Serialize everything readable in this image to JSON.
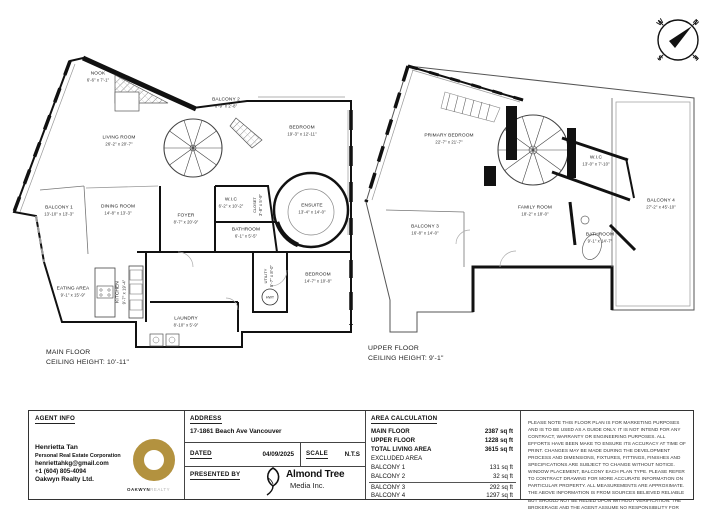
{
  "compass": {
    "n": "N",
    "e": "E",
    "s": "S",
    "w": "W"
  },
  "main_floor": {
    "title": "MAIN FLOOR",
    "ceiling": "CEILING HEIGHT: 10'-11\"",
    "hwt": "HWT",
    "rooms": [
      {
        "name": "NOOK",
        "dims": "6'-6\" x 7'-1\""
      },
      {
        "name": "LIVING ROOM",
        "dims": "26'-2\" x 20'-7\""
      },
      {
        "name": "BALCONY 2",
        "dims": "8'-9\" x 2'-8\""
      },
      {
        "name": "BEDROOM",
        "dims": "19'-3\" x 12'-11\""
      },
      {
        "name": "BALCONY 1",
        "dims": "13'-10\" x 13'-3\""
      },
      {
        "name": "DINING ROOM",
        "dims": "14'-8\" x 13'-3\""
      },
      {
        "name": "FOYER",
        "dims": "8'-7\" x 20'-9\""
      },
      {
        "name": "W.I.C",
        "dims": "6'-2\" x 10'-2\""
      },
      {
        "name": "ENSUITE",
        "dims": "13'-4\" x 14'-0\""
      },
      {
        "name": "BATHROOM",
        "dims": "6'-1\" x 5'-5\""
      },
      {
        "name": "CLOSET",
        "dims": "3'-8\" x 5'-9\""
      },
      {
        "name": "EATING AREA",
        "dims": "9'-1\" x 15'-9\""
      },
      {
        "name": "KITCHEN",
        "dims": "9'-7\" x 19'-4\""
      },
      {
        "name": "BEDROOM",
        "dims": "14'-7\" x 10'-8\""
      },
      {
        "name": "UTILITY",
        "dims": "5'-7\" x 8'-0\""
      },
      {
        "name": "LAUNDRY",
        "dims": "8'-10\" x 5'-9\""
      }
    ]
  },
  "upper_floor": {
    "title": "UPPER FLOOR",
    "ceiling": "CEILING HEIGHT: 9'-1\"",
    "rooms": [
      {
        "name": "PRIMARY BEDROOM",
        "dims": "22'-7\" x 21'-7\""
      },
      {
        "name": "W.I.C",
        "dims": "13'-0\" x 7'-10\""
      },
      {
        "name": "FAMILY ROOM",
        "dims": "18'-2\" x 18'-0\""
      },
      {
        "name": "BALCONY 3",
        "dims": "16'-8\" x 14'-0\""
      },
      {
        "name": "BALCONY 4",
        "dims": "27'-2\" x 45'-10\""
      },
      {
        "name": "BATHROOM",
        "dims": "9'-1\" x 14'-7\""
      }
    ]
  },
  "footer": {
    "agent": {
      "header": "AGENT INFO",
      "name": "Henrietta Tan",
      "title": "Personal Real Estate Corporation",
      "email": "henriettahkg@gmail.com",
      "phone": "+1 (604) 805-4094",
      "company": "Oakwyn Realty Ltd.",
      "logo_primary": "OAKWYN",
      "logo_secondary": "REALTY",
      "logo_color": "#b3923f"
    },
    "address": {
      "header": "ADDRESS",
      "value": "17-1861 Beach Ave Vancouver",
      "dated_label": "DATED",
      "dated_value": "04/09/2025",
      "scale_label": "SCALE",
      "scale_value": "N.T.S",
      "presented_label": "PRESENTED BY",
      "media_name": "Almond Tree",
      "media_sub": "Media Inc."
    },
    "area": {
      "header": "AREA CALCULATION",
      "rows": [
        {
          "label": "MAIN FLOOR",
          "value": "2387 sq ft"
        },
        {
          "label": "UPPER FLOOR",
          "value": "1228 sq ft"
        },
        {
          "label": "TOTAL LIVING AREA",
          "value": "3615 sq ft"
        },
        {
          "label": "EXCLUDED AREA",
          "value": ""
        },
        {
          "label": "BALCONY 1",
          "value": "131 sq ft"
        },
        {
          "label": "BALCONY 2",
          "value": "32 sq ft"
        },
        {
          "label": "BALCONY 3",
          "value": "292 sq ft"
        },
        {
          "label": "BALCONY 4",
          "value": "1297 sq ft"
        }
      ]
    },
    "disclaimer": "PLEASE NOTE THIS FLOOR PLAN IS FOR MARKETING PURPOSES AND IS TO BE USED AS A GUIDE ONLY. IT IS NOT INTEND FOR ANY CONTRACT, WARRANTY OR ENGINEERING PURPOSES. ALL EFFORTS HAVE BEEN MAKE TO ENSURE ITS ACCURACY AT TIME OF PRINT. CHANGES MAY BE MADE DURING THE DEVELOPMENT PROCESS AND DIMENSIONS, FIXTURES, FITTINGS, FINISHES AND SPECIFICATIONS ARE SUBJECT TO CHANGE WITHOUT NOTICE. WINDOW PLACEMENT, BALCONY EACH PLAN TYPE. PLEASE REFER TO CONTRACT DRAWING FOR MORE ACCURATE INFORMATION ON PARTICULAR PROPERTY. ALL MEASUREMENTS ARE APPROXIMATE. THE ABOVE INFORMATION IS FROM SOURCES BELIEVED RELIABLE BUT SHOULD NOT BE RELIED UPON WITHOUT VERIFICATION. THE BROKERAGE AND THE AGENT ASSUME NO RESPONSIBILITY FOR ITS ACCURACY"
  }
}
